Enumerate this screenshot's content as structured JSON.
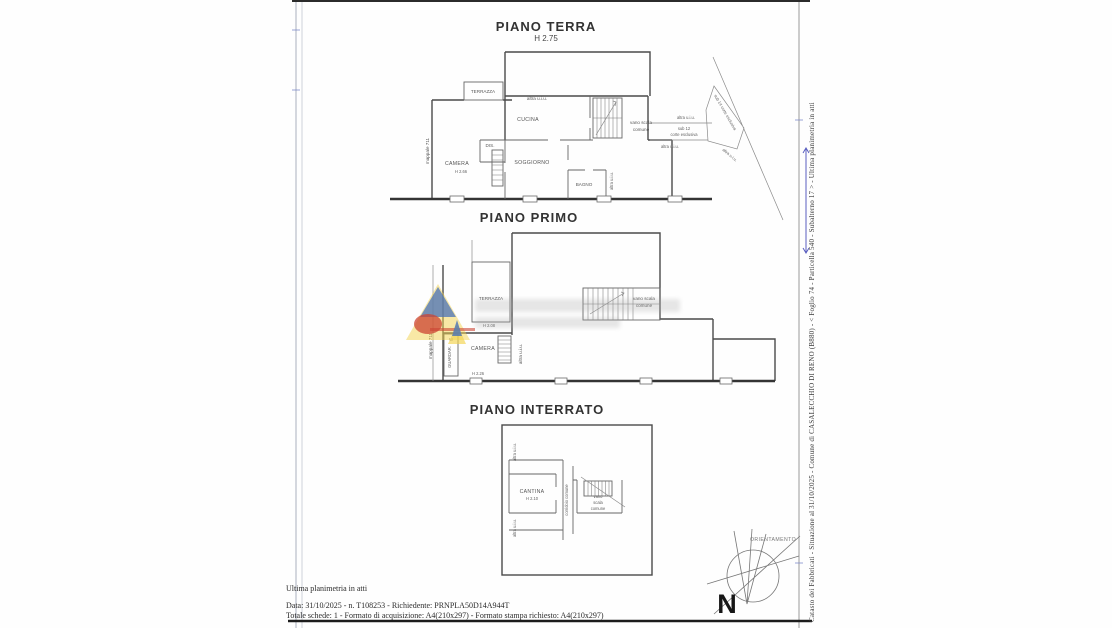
{
  "colors": {
    "wall_dark": "#3a3a3a",
    "wall": "#5f5f5f",
    "label": "#555555",
    "annotation_blue": "#5a5fc0",
    "watermark_yellow": "#f2d24b",
    "watermark_blue": "#4a72b8",
    "watermark_red": "#cc4433"
  },
  "document": {
    "side_text": "Catasto dei Fabbricati - Situazione al 31/10/2025 - Comune di CASALECCHIO DI RENO (B880) - < Foglio 74 - Particella 540 - Subalterno 17 > - Ultima planimetria in atti",
    "footer_line1": "Ultima planimetria in atti",
    "footer_line2": "Data: 31/10/2025 - n. T108253 - Richiedente: PRNPLA50D14A944T",
    "footer_line3": "Totale schede: 1 - Formato di acquisizione: A4(210x297)  - Formato stampa richiesto: A4(210x297)",
    "orientation_label": "ORIENTAMENTO",
    "north_label": "N"
  },
  "piano_terra": {
    "title": "PIANO TERRA",
    "height_note": "H 2.75",
    "labels": {
      "terrazza": "TERRAZZA",
      "altra_top": "altra u.i.u.",
      "cucina": "CUCINA",
      "dis": "DIS.",
      "camera": "CAMERA",
      "camera_h": "H 2.66",
      "soggiorno": "SOGGIORNO",
      "bagno": "BAGNO",
      "altra_bagno": "altra u.i.u.",
      "vano_scala_line1": "vano scala",
      "vano_scala_line2": "comune",
      "altra_right_top": "altra u.i.u.",
      "sub12_line1": "sub 12",
      "sub12_line2": "corte esclusiva",
      "altra_right_mid": "altra u.i.u.",
      "sub14_diag": "sub 14 corte esclusiva",
      "altra_diag": "altra u.i.u.",
      "mappale": "mappale 711"
    }
  },
  "piano_primo": {
    "title": "PIANO PRIMO",
    "labels": {
      "terrazza": "TERRAZZA",
      "terrazza_h": "H 2.08",
      "camera": "CAMERA",
      "camera_h": "H 2.26",
      "guardaroba": "GUARDAR.",
      "w": "W",
      "altra_vert": "altra u.i.u.",
      "mappale": "mappale 711",
      "vano_scala_line1": "vano scala",
      "vano_scala_line2": "comune"
    }
  },
  "piano_interrato": {
    "title": "PIANO INTERRATO",
    "labels": {
      "altra_top": "altra u.i.u.",
      "altra_bottom": "altra u.i.u.",
      "cantina": "CANTINA",
      "cantina_h": "H 2.10",
      "corridoio": "corridoio comune",
      "vano_line1": "vano",
      "vano_line2": "scala",
      "vano_line3": "comune"
    }
  }
}
